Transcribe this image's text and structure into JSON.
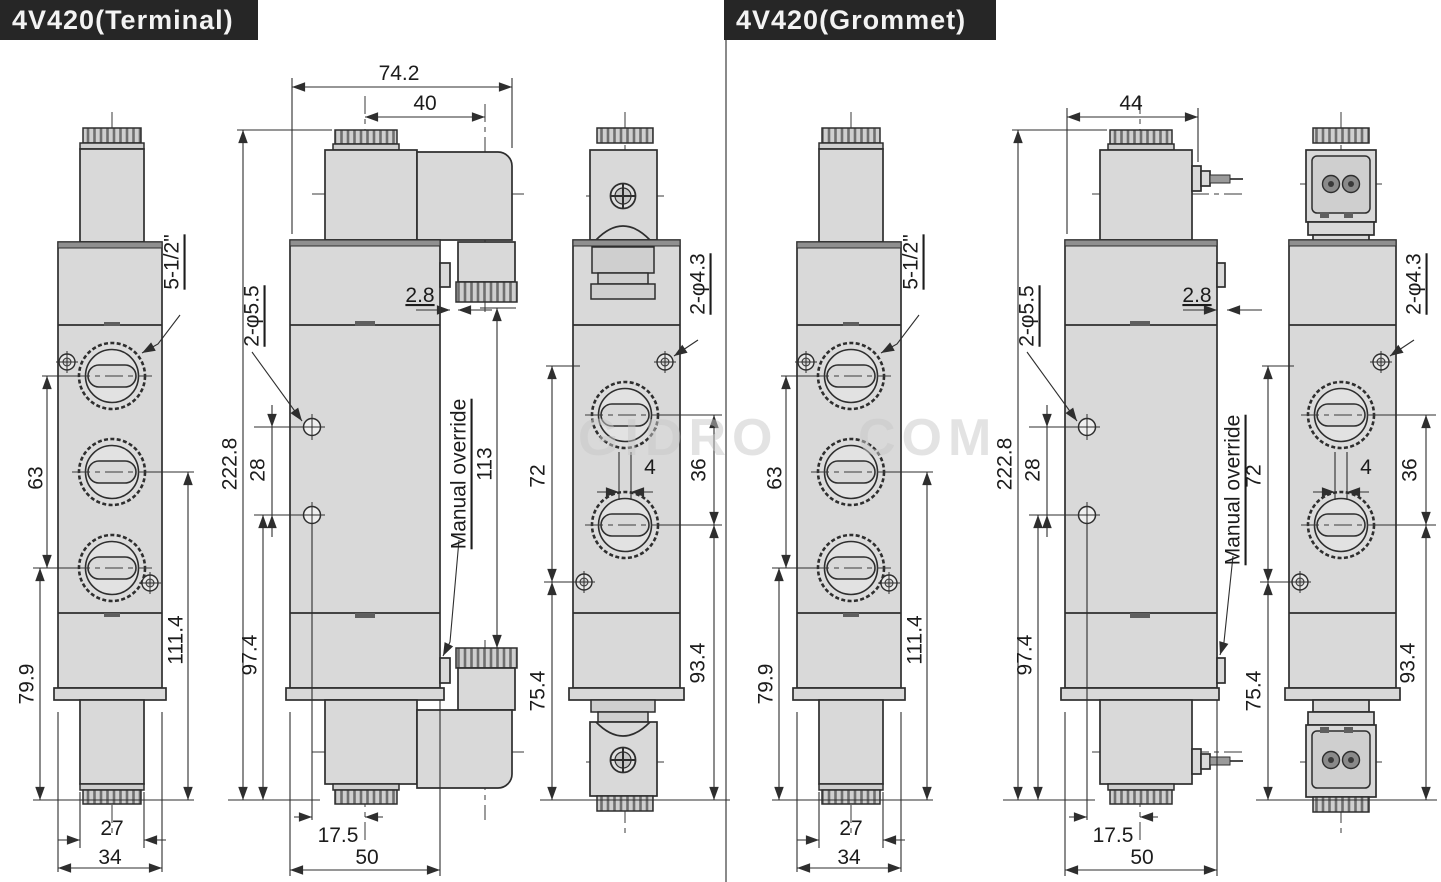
{
  "titles": {
    "terminal": "4V420(Terminal)",
    "grommet": "4V420(Grommet)"
  },
  "watermark": {
    "left": "GIDRO",
    "right": "COM"
  },
  "terminal": {
    "port_view": {
      "port_size_label": "5-1/2\"",
      "dim_port_span": "63",
      "dim_lower": "79.9",
      "dim_right": "111.4",
      "dim_width_inner": "27",
      "dim_width_outer": "34"
    },
    "front_view": {
      "dim_overall_width": "74.2",
      "dim_connector_offset": "40",
      "dim_gap": "2.8",
      "mount_holes_label": "2-φ5.5",
      "dim_hole_spacing": "28",
      "dim_overall_height": "222.8",
      "dim_lower_height": "97.4",
      "manual_override_label": "Manual override",
      "dim_connector_height": "113",
      "dim_hole_offset": "17.5",
      "dim_body_width": "50"
    },
    "side_view": {
      "pilot_holes_label": "2-φ4.3",
      "dim_upper": "72",
      "dim_port_offset": "4",
      "dim_port_spacing": "36",
      "dim_lower": "75.4",
      "dim_right": "93.4"
    }
  },
  "grommet": {
    "port_view": {
      "port_size_label": "5-1/2\"",
      "dim_port_span": "63",
      "dim_lower": "79.9",
      "dim_right": "111.4",
      "dim_width_inner": "27",
      "dim_width_outer": "34"
    },
    "front_view": {
      "dim_coil_width": "44",
      "dim_gap": "2.8",
      "mount_holes_label": "2-φ5.5",
      "dim_hole_spacing": "28",
      "dim_overall_height": "222.8",
      "dim_lower_height": "97.4",
      "manual_override_label": "Manual override",
      "dim_hole_offset": "17.5",
      "dim_body_width": "50"
    },
    "side_view": {
      "pilot_holes_label": "2-φ4.3",
      "dim_upper": "72",
      "dim_port_offset": "4",
      "dim_port_spacing": "36",
      "dim_lower": "75.4",
      "dim_right": "93.4"
    }
  }
}
